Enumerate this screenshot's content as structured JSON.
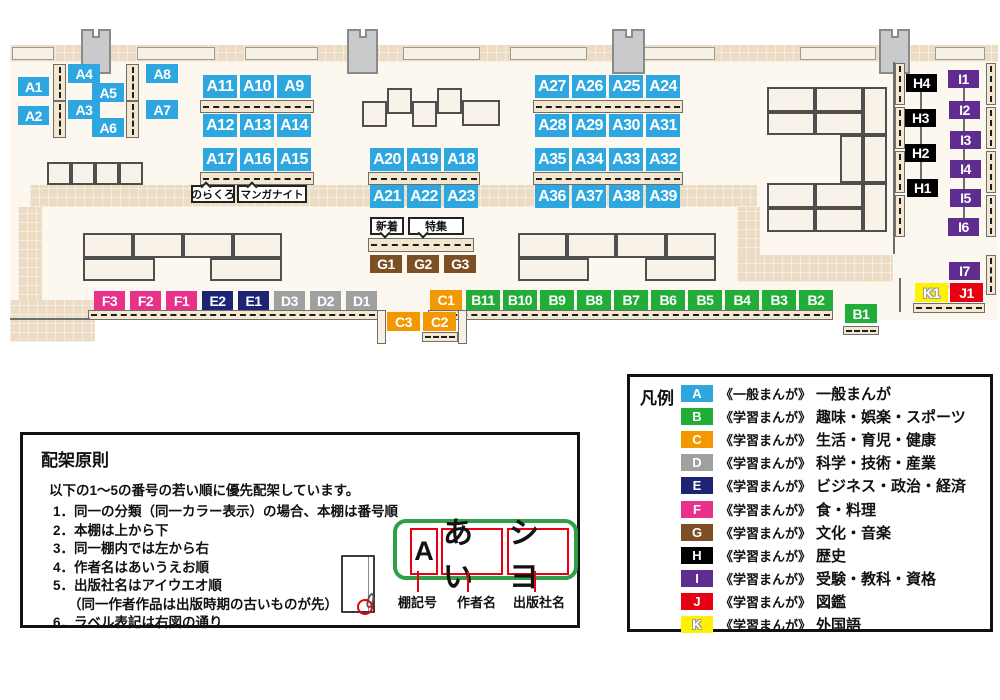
{
  "map": {
    "label_rows": [
      [
        "A1"
      ],
      [
        "A2"
      ],
      [
        "A4"
      ],
      [
        "A3"
      ],
      [
        "A5"
      ],
      [
        "A6"
      ],
      [
        "A8"
      ],
      [
        "A7"
      ],
      [
        "A11",
        "A10",
        "A9"
      ],
      [
        "A12",
        "A13",
        "A14"
      ],
      [
        "A17",
        "A16",
        "A15"
      ],
      [
        "A20",
        "A19",
        "A18"
      ],
      [
        "A21",
        "A22",
        "A23"
      ],
      [
        "A27",
        "A26",
        "A25",
        "A24"
      ],
      [
        "A28",
        "A29",
        "A30",
        "A31"
      ],
      [
        "A35",
        "A34",
        "A33",
        "A32"
      ],
      [
        "A36",
        "A37",
        "A38",
        "A39"
      ],
      [
        "G1",
        "G2",
        "G3"
      ],
      [
        "F3",
        "F2",
        "F1",
        "E2",
        "E1",
        "D3",
        "D2",
        "D1"
      ],
      [
        "C1"
      ],
      [
        "B11",
        "B10",
        "B9",
        "B8",
        "B7",
        "B6",
        "B5",
        "B4",
        "B3",
        "B2"
      ],
      [
        "C3",
        "C2"
      ],
      [
        "B1"
      ],
      [
        "H4"
      ],
      [
        "H3"
      ],
      [
        "H2"
      ],
      [
        "H1"
      ],
      [
        "I1"
      ],
      [
        "I2"
      ],
      [
        "I3"
      ],
      [
        "I4"
      ],
      [
        "I5"
      ],
      [
        "I6"
      ],
      [
        "I7"
      ],
      [
        "K1"
      ],
      [
        "J1"
      ]
    ],
    "signs": [
      {
        "name": "norakuro-sign",
        "text": "のらくろ",
        "tail": "up"
      },
      {
        "name": "manga-night-sign",
        "text": "マンガナイト",
        "tail": "up"
      },
      {
        "name": "new-arrivals-sign",
        "text": "新着",
        "tail": "down"
      },
      {
        "name": "feature-sign",
        "text": "特集",
        "tail": "down"
      }
    ]
  },
  "legend": {
    "title": "凡例",
    "items": [
      {
        "key": "A",
        "color": "#2EA7E0",
        "series": "《一般まんが》",
        "category": "一般まんが"
      },
      {
        "key": "B",
        "color": "#22AC38",
        "series": "《学習まんが》",
        "category": "趣味・娯楽・スポーツ"
      },
      {
        "key": "C",
        "color": "#F39800",
        "series": "《学習まんが》",
        "category": "生活・育児・健康"
      },
      {
        "key": "D",
        "color": "#9FA0A0",
        "series": "《学習まんが》",
        "category": "科学・技術・産業"
      },
      {
        "key": "E",
        "color": "#1D2473",
        "series": "《学習まんが》",
        "category": "ビジネス・政治・経済"
      },
      {
        "key": "F",
        "color": "#E7318A",
        "series": "《学習まんが》",
        "category": "食・料理"
      },
      {
        "key": "G",
        "color": "#7C4F24",
        "series": "《学習まんが》",
        "category": "文化・音楽"
      },
      {
        "key": "H",
        "color": "#000000",
        "series": "《学習まんが》",
        "category": "歴史"
      },
      {
        "key": "I",
        "color": "#5F2C90",
        "series": "《学習まんが》",
        "category": "受験・教科・資格"
      },
      {
        "key": "J",
        "color": "#E60012",
        "series": "《学習まんが》",
        "category": "図鑑"
      },
      {
        "key": "K",
        "color": "#FFF100",
        "series": "《学習まんが》",
        "category": "外国語",
        "outlined": true
      }
    ]
  },
  "principles": {
    "title": "配架原則",
    "intro": "以下の1～5の番号の若い順に優先配架しています。",
    "rules": [
      "1．同一の分類（同一カラー表示）の場合、本棚は番号順",
      "2．本棚は上から下",
      "3．同一棚内では左から右",
      "4．作者名はあいうえお順",
      "5．出版社名はアイウエオ順",
      "（同一作者作品は出版時期の古いものが先）",
      "6．ラベル表記は右図の通り"
    ],
    "diagram": {
      "label_boxes": [
        "A",
        "あい",
        "シヨ"
      ],
      "captions": [
        "棚記号",
        "作者名",
        "出版社名"
      ]
    }
  }
}
